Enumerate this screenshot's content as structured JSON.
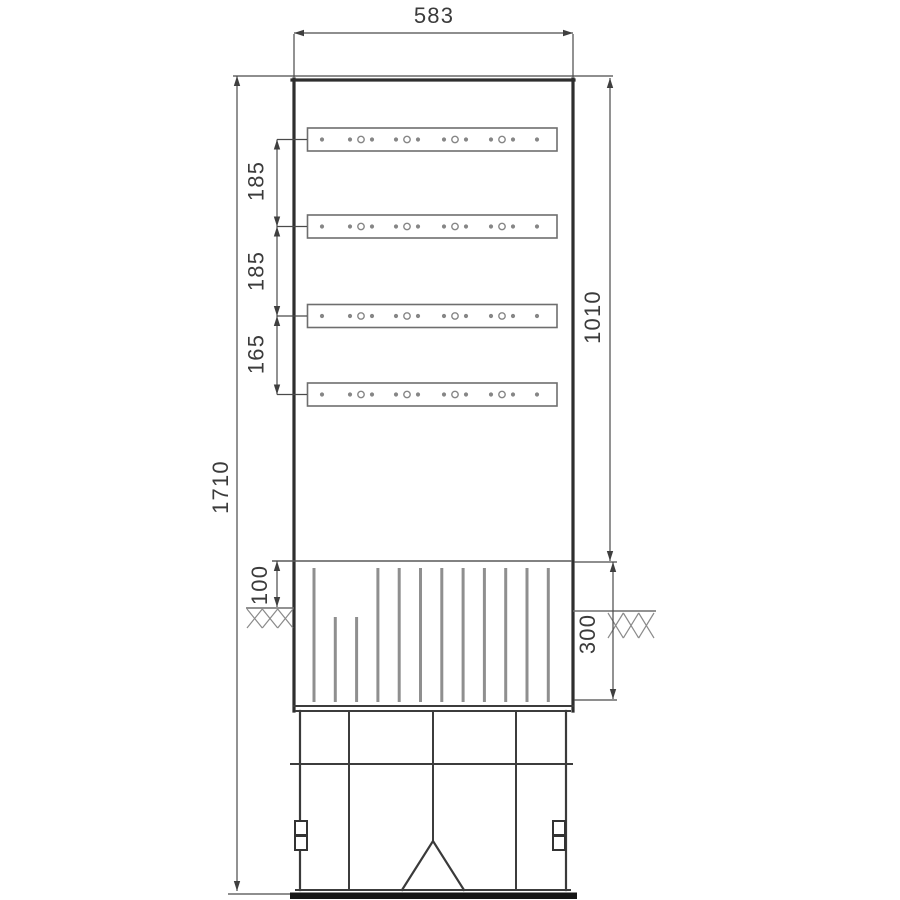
{
  "drawing": {
    "kind": "dimensioned front elevation of cable distribution cabinet",
    "units": "mm"
  },
  "dims": {
    "width": "583",
    "gap1": "185",
    "gap2": "185",
    "gap3": "165",
    "body_height": "1010",
    "total_height": "1710",
    "ground_offset": "100",
    "foundation_depth": "300"
  },
  "components": {
    "rail_rows": 4,
    "holes_per_rail": 14,
    "slat_count": 12,
    "earth_symbol": "crosshatch"
  },
  "style": {
    "outline_color": "#2e2e2e",
    "dim_color": "#4a4a4a",
    "arrow_color": "#3f3f3f",
    "slat_color": "#8f8f8f",
    "rail_border": "#6e6e6e",
    "hole_color": "#868686",
    "earth_color": "#8a8a8a",
    "footer_bar": "#161616"
  }
}
